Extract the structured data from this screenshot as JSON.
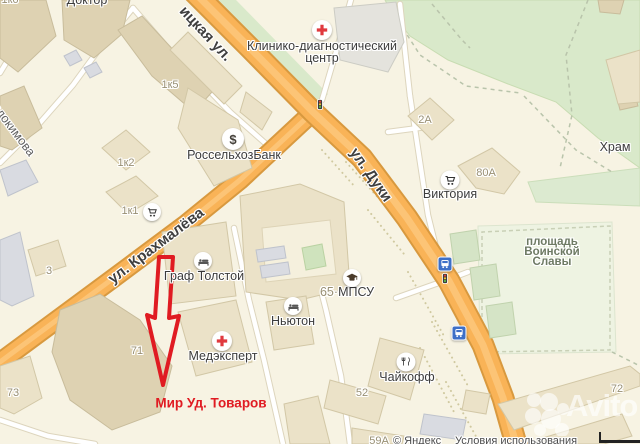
{
  "streets": {
    "top": "ицкая ул.",
    "duki": "ул. Дуки",
    "krakh": "ул. Крахмалёва",
    "evdok": "вдокимова"
  },
  "pois": {
    "doktor": "Доктор",
    "clinic_line1": "Клинико-диагностический",
    "clinic_line2": "центр",
    "bank": "РоссельхозБанк",
    "victoria": "Виктория",
    "hram": "Храм",
    "graf": "Граф Толстой",
    "newton": "Ньютон",
    "mpsu_num": "65·",
    "mpsu": "МПСУ",
    "medexpert": "Медэксперт",
    "chaikoff": "Чайкофф",
    "square_l1": "площадь",
    "square_l2": "Воинской",
    "square_l3": "Славы"
  },
  "nums": {
    "k6": "1к6",
    "k5": "1к5",
    "k2": "1к2",
    "k1": "1к1",
    "a2": "2А",
    "a80": "80А",
    "b3": "3",
    "b71": "71",
    "b73": "73",
    "b52": "52",
    "b72": "72",
    "a59": "59А"
  },
  "marker": {
    "label": "Мир Уд. Товаров",
    "color": "#e01b22"
  },
  "attribution": {
    "copyright": "© Яндекс",
    "terms": "Условия использования"
  },
  "watermark": "Avito",
  "icons": {
    "bank": "$",
    "medical": "red-cross",
    "hotel": "bed",
    "shop": "cart",
    "education": "grad-cap",
    "restaurant": "fork-knife",
    "transport": "bus",
    "signal": "traffic-light"
  },
  "colors": {
    "road_orange": "#f9b357",
    "marker_red": "#e01b22",
    "bus_blue": "#3d6fc7",
    "park_green": "#d9e9ca",
    "background": "#f7f3e3"
  }
}
